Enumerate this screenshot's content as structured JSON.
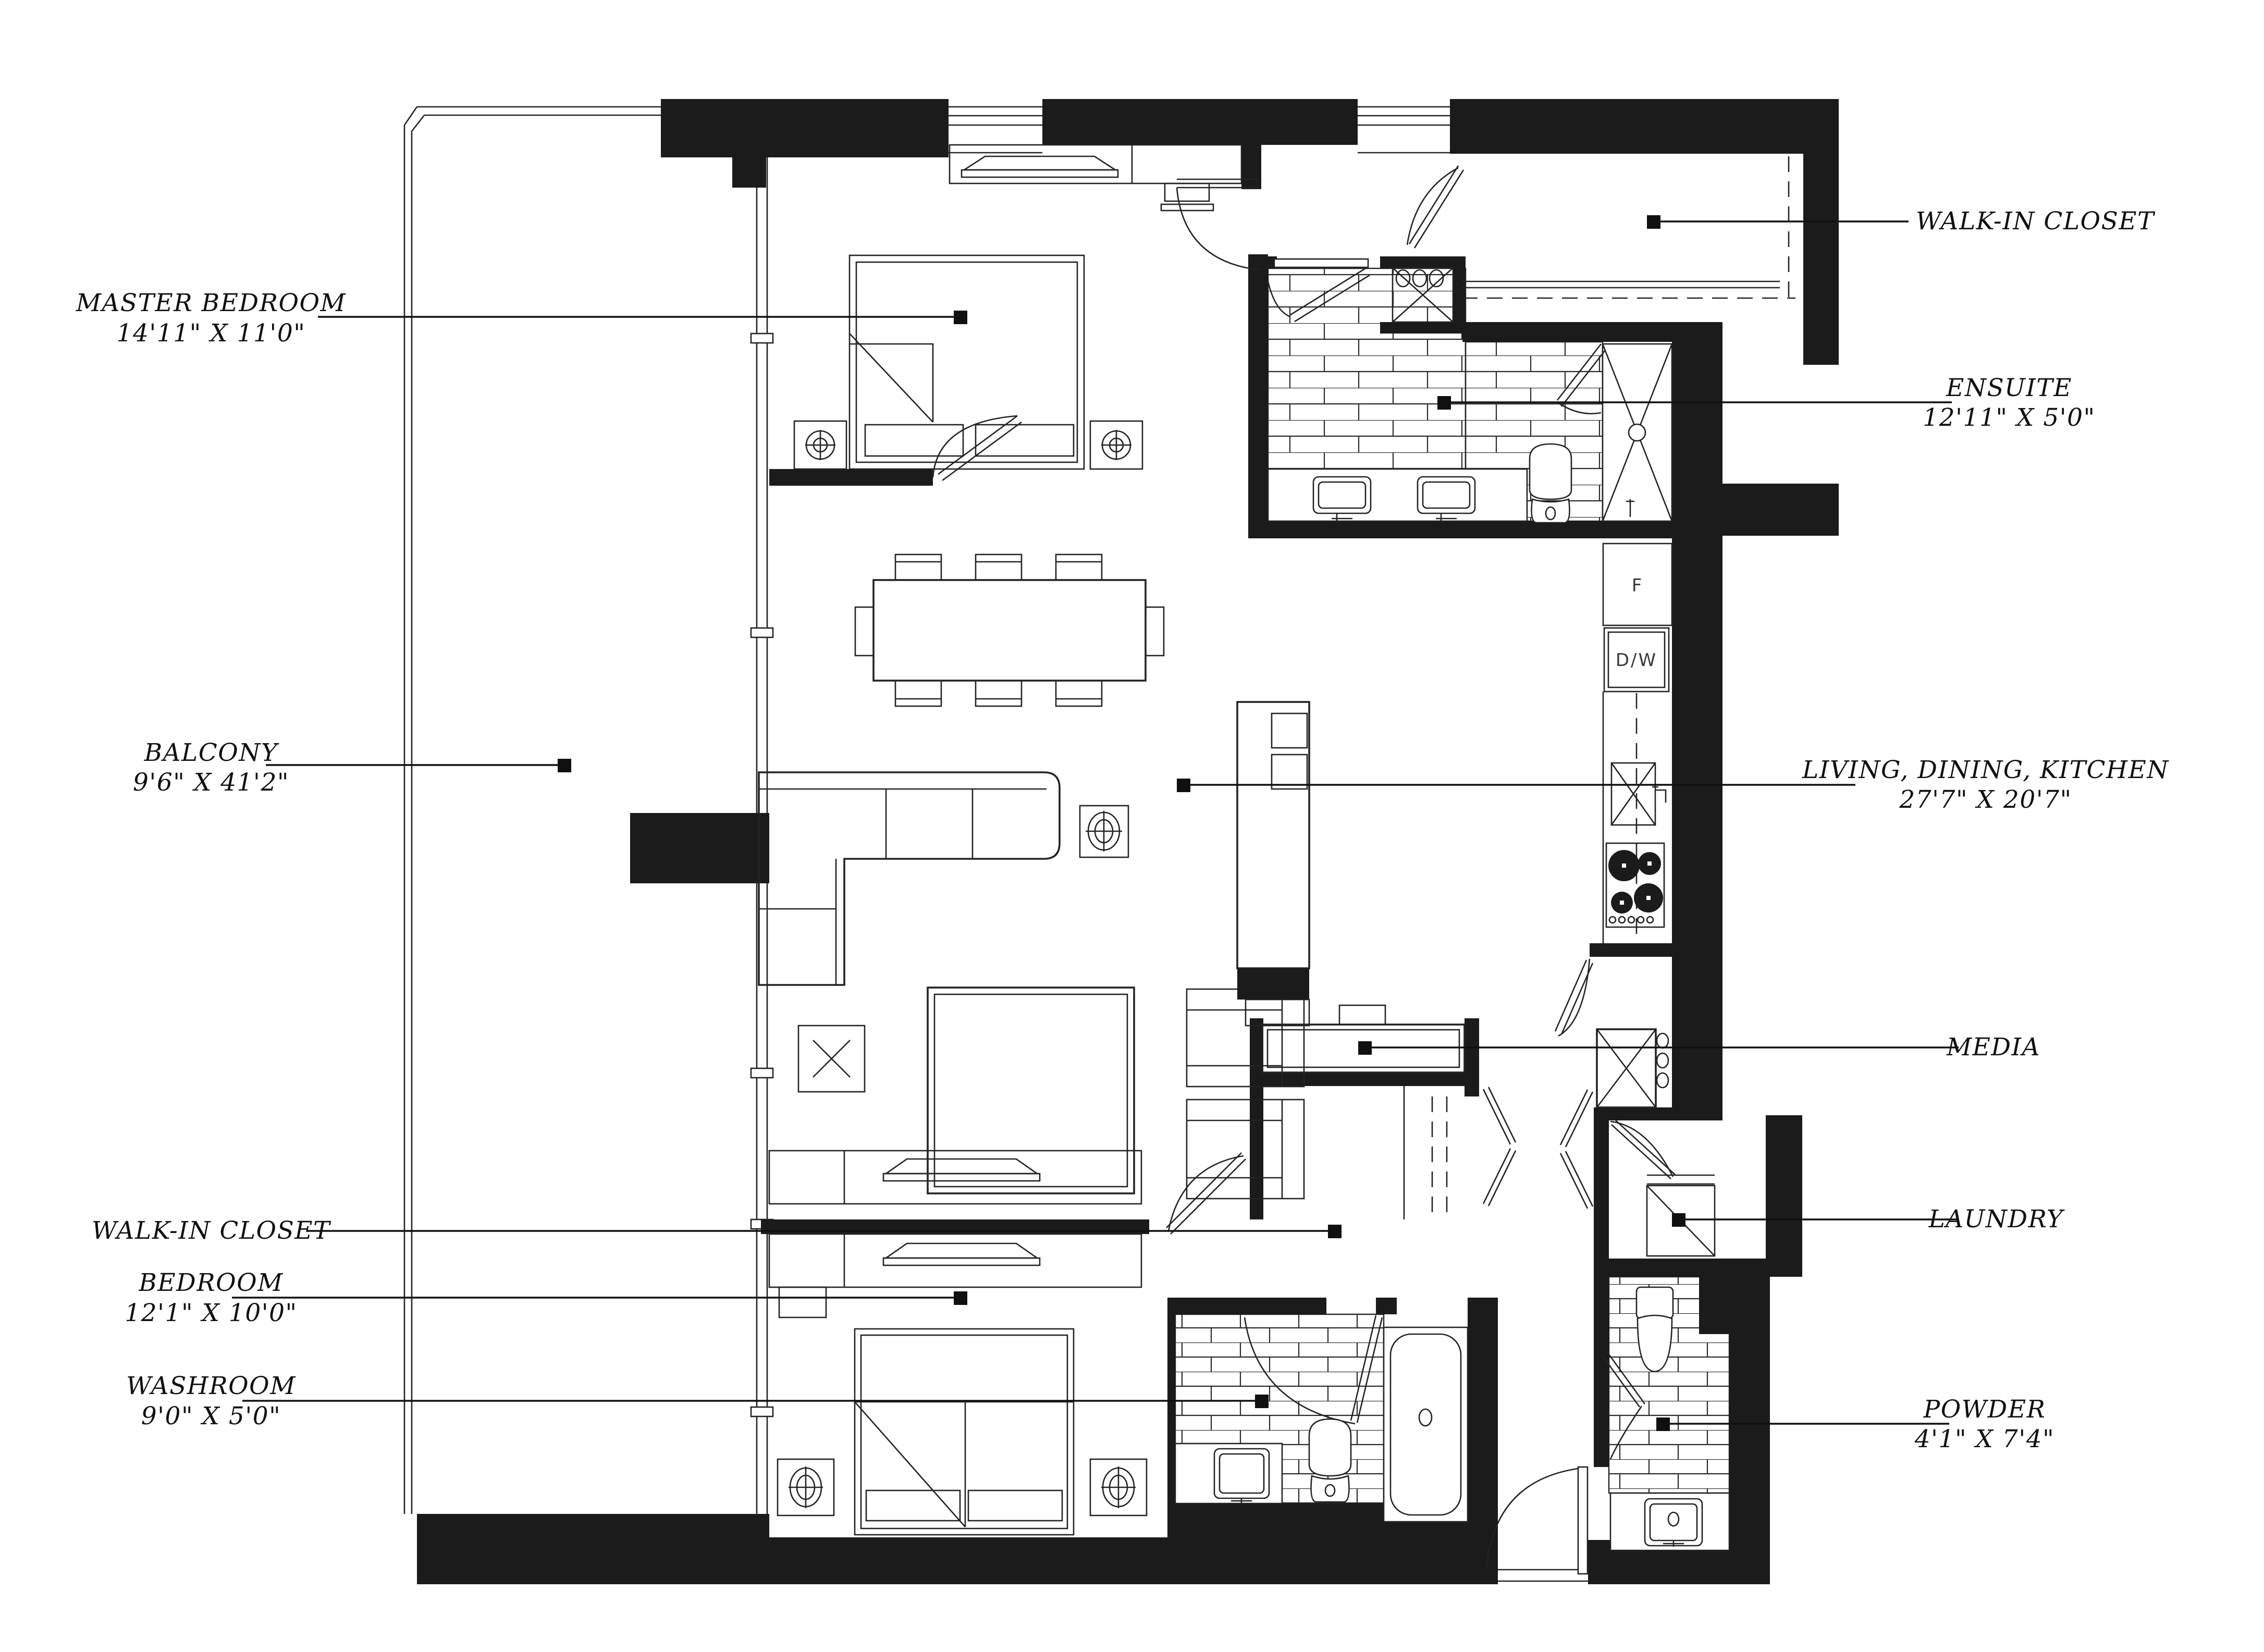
{
  "plan": {
    "type": "residential-floor-plan",
    "colors": {
      "ink": "#1b1b1b",
      "background": "#ffffff"
    },
    "rooms": [
      {
        "id": "master-bedroom",
        "label": "MASTER BEDROOM",
        "dimensions": "14'11\" X 11'0\""
      },
      {
        "id": "balcony",
        "label": "BALCONY",
        "dimensions": "9'6\" X 41'2\""
      },
      {
        "id": "walk-in-closet-left",
        "label": "WALK-IN CLOSET",
        "dimensions": ""
      },
      {
        "id": "bedroom",
        "label": "BEDROOM",
        "dimensions": "12'1\" X 10'0\""
      },
      {
        "id": "washroom",
        "label": "WASHROOM",
        "dimensions": "9'0\" X 5'0\""
      },
      {
        "id": "walk-in-closet-right",
        "label": "WALK-IN CLOSET",
        "dimensions": ""
      },
      {
        "id": "ensuite",
        "label": "ENSUITE",
        "dimensions": "12'11\" X 5'0\""
      },
      {
        "id": "living-dining-kitchen",
        "label": "LIVING, DINING, KITCHEN",
        "dimensions": "27'7\" X 20'7\""
      },
      {
        "id": "media",
        "label": "MEDIA",
        "dimensions": ""
      },
      {
        "id": "laundry",
        "label": "LAUNDRY",
        "dimensions": ""
      },
      {
        "id": "powder",
        "label": "POWDER",
        "dimensions": "4'1\" X 7'4\""
      }
    ],
    "appliances": {
      "fridge": "F",
      "dishwasher": "D/W"
    }
  }
}
